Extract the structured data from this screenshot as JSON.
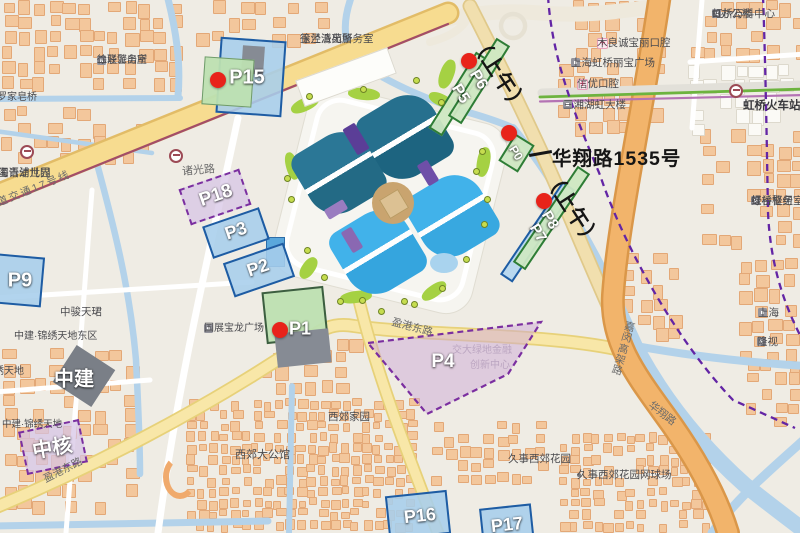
{
  "annotations": {
    "morning_top": "（上午）",
    "morning_mid": "（上午）",
    "address": "华翔路1535号"
  },
  "parking": {
    "shapes": [
      {
        "cls": "blue",
        "cx": 251,
        "cy": 77,
        "w": 66,
        "h": 76,
        "rot": 4
      },
      {
        "cls": "gray",
        "cx": 253,
        "cy": 60,
        "w": 22,
        "h": 28,
        "rot": 4
      },
      {
        "cls": "green",
        "cx": 228,
        "cy": 82,
        "w": 50,
        "h": 48,
        "rot": 4
      },
      {
        "cls": "greenbar",
        "cx": 459,
        "cy": 94,
        "w": 16,
        "h": 90,
        "rot": 32
      },
      {
        "cls": "greenbar",
        "cx": 479,
        "cy": 81,
        "w": 16,
        "h": 92,
        "rot": 32
      },
      {
        "cls": "greenbar",
        "cx": 516,
        "cy": 153,
        "w": 23,
        "h": 32,
        "rot": 32
      },
      {
        "cls": "bluebar",
        "cx": 537,
        "cy": 232,
        "w": 15,
        "h": 112,
        "rot": 34
      },
      {
        "cls": "greenbar",
        "cx": 551,
        "cy": 218,
        "w": 15,
        "h": 116,
        "rot": 34
      },
      {
        "cls": "pdash",
        "cx": 215,
        "cy": 197,
        "w": 64,
        "h": 38,
        "rot": -19
      },
      {
        "cls": "blue",
        "cx": 236,
        "cy": 233,
        "w": 60,
        "h": 34,
        "rot": -19
      },
      {
        "cls": "blue",
        "cx": 259,
        "cy": 270,
        "w": 64,
        "h": 36,
        "rot": -19
      },
      {
        "cls": "blue",
        "cx": 14,
        "cy": 280,
        "w": 58,
        "h": 50,
        "rot": 5
      },
      {
        "cls": "green2",
        "cx": 295,
        "cy": 315,
        "w": 62,
        "h": 52,
        "rot": -6
      },
      {
        "cls": "gray",
        "cx": 303,
        "cy": 348,
        "w": 54,
        "h": 34,
        "rot": -6
      },
      {
        "cls": "blue",
        "cx": 418,
        "cy": 515,
        "w": 62,
        "h": 44,
        "rot": -6
      },
      {
        "cls": "blue",
        "cx": 507,
        "cy": 526,
        "w": 52,
        "h": 40,
        "rot": -6
      },
      {
        "cls": "darkgray",
        "cx": 84,
        "cy": 376,
        "w": 46,
        "h": 44,
        "rot": 33
      },
      {
        "cls": "pdash",
        "cx": 53,
        "cy": 447,
        "w": 62,
        "h": 44,
        "rot": -12
      }
    ],
    "labels": [
      {
        "t": "P15",
        "x": 247,
        "y": 78,
        "s": 20
      },
      {
        "t": "P6",
        "x": 478,
        "y": 80,
        "s": 16,
        "r": 58
      },
      {
        "t": "P5",
        "x": 460,
        "y": 94,
        "s": 16,
        "r": 58
      },
      {
        "t": "P0",
        "x": 516,
        "y": 153,
        "s": 12,
        "r": 58
      },
      {
        "t": "P8",
        "x": 550,
        "y": 220,
        "s": 15,
        "r": 58
      },
      {
        "t": "P7",
        "x": 538,
        "y": 233,
        "s": 15,
        "r": 58
      },
      {
        "t": "P18",
        "x": 216,
        "y": 196,
        "s": 19,
        "r": -19
      },
      {
        "t": "P3",
        "x": 236,
        "y": 231,
        "s": 18,
        "r": -19
      },
      {
        "t": "P2",
        "x": 258,
        "y": 268,
        "s": 18,
        "r": -19
      },
      {
        "t": "P9",
        "x": 20,
        "y": 281,
        "s": 20
      },
      {
        "t": "P1",
        "x": 300,
        "y": 329,
        "s": 18
      },
      {
        "t": "P4",
        "x": 443,
        "y": 362,
        "s": 19
      },
      {
        "t": "P16",
        "x": 420,
        "y": 516,
        "s": 18,
        "r": -6
      },
      {
        "t": "P17",
        "x": 507,
        "y": 525,
        "s": 18,
        "r": -6
      },
      {
        "t": "中建",
        "x": 74,
        "y": 377,
        "s": 20
      },
      {
        "t": "中核",
        "x": 52,
        "y": 446,
        "s": 20,
        "r": -10
      }
    ],
    "red_dots": [
      [
        218,
        80
      ],
      [
        469,
        61
      ],
      [
        509,
        133
      ],
      [
        544,
        201
      ],
      [
        280,
        330
      ]
    ],
    "p4_polygon": "368,343 541,322 508,374 427,414"
  },
  "necc": {
    "grounds": {
      "cx": 390,
      "cy": 200,
      "w": 206,
      "h": 196,
      "rot": 14
    },
    "ring": {
      "cx": 390,
      "cy": 200,
      "w": 186,
      "h": 176,
      "rot": 14
    },
    "leaves": [
      {
        "cx": 405,
        "cy": 137,
        "s": 78,
        "rot": 59,
        "c1": "#26708e",
        "c2": "#1d6480"
      },
      {
        "cx": 339,
        "cy": 173,
        "s": 76,
        "rot": 59,
        "c1": "#2b7796",
        "c2": "#236a85"
      },
      {
        "cx": 378,
        "cy": 252,
        "s": 78,
        "rot": 59,
        "c1": "#41b2ea",
        "c2": "#35a5de"
      },
      {
        "cx": 452,
        "cy": 216,
        "s": 76,
        "rot": 59,
        "c1": "#41b2ea",
        "c2": "#38a8e0"
      }
    ],
    "purples": [
      {
        "cx": 356,
        "cy": 139,
        "w": 30,
        "h": 14,
        "rot": 59,
        "c": "#5b3e97"
      },
      {
        "cx": 428,
        "cy": 173,
        "w": 24,
        "h": 12,
        "rot": 59,
        "c": "#6f4fa8"
      },
      {
        "cx": 336,
        "cy": 209,
        "w": 22,
        "h": 11,
        "rot": -31,
        "c": "#9a7cc0"
      },
      {
        "cx": 352,
        "cy": 240,
        "w": 24,
        "h": 12,
        "rot": 59,
        "c": "#8a68b2"
      }
    ],
    "lawns": [
      {
        "cx": 305,
        "cy": 104,
        "w": 30,
        "h": 13,
        "rot": -25
      },
      {
        "cx": 364,
        "cy": 94,
        "w": 32,
        "h": 12,
        "rot": 5
      },
      {
        "cx": 441,
        "cy": 100,
        "w": 26,
        "h": 12,
        "rot": 25
      },
      {
        "cx": 483,
        "cy": 162,
        "w": 13,
        "h": 30,
        "rot": 10
      },
      {
        "cx": 486,
        "cy": 224,
        "w": 13,
        "h": 28,
        "rot": 25
      },
      {
        "cx": 434,
        "cy": 291,
        "w": 28,
        "h": 12,
        "rot": -35
      },
      {
        "cx": 356,
        "cy": 297,
        "w": 32,
        "h": 12,
        "rot": -8
      },
      {
        "cx": 292,
        "cy": 166,
        "w": 12,
        "h": 28,
        "rot": -15
      },
      {
        "cx": 447,
        "cy": 74,
        "w": 14,
        "h": 30,
        "rot": 20
      },
      {
        "cx": 308,
        "cy": 268,
        "w": 13,
        "h": 24,
        "rot": 35
      }
    ],
    "center": {
      "cx": 393,
      "cy": 203,
      "r": 21,
      "c": "#c9a46f",
      "sq": 20,
      "sqc": "#dcc193"
    },
    "pond": {
      "cx": 444,
      "cy": 263,
      "w": 28,
      "h": 20,
      "c": "#a9d3ee"
    },
    "west_building": {
      "cx": 274,
      "cy": 251,
      "w": 17,
      "h": 28,
      "c": "#5aa7dc",
      "bc": "#2d6da8"
    },
    "white_building": {
      "cx": 345,
      "cy": 76,
      "w": 96,
      "h": 26,
      "rot": -20
    },
    "arc_building": {
      "cx": 180,
      "cy": 477,
      "w": 34,
      "h": 44
    }
  },
  "streets": [
    {
      "t": "诸光路",
      "x": 182,
      "y": 163,
      "r": -5,
      "s": 11
    },
    {
      "t": "轨道交通17号线",
      "x": -14,
      "y": 200,
      "r": -22,
      "s": 10.5,
      "sp": 2
    },
    {
      "t": "盈港东路",
      "x": 392,
      "y": 314,
      "r": 15,
      "s": 10.5
    },
    {
      "t": "盈港东路",
      "x": 44,
      "y": 472,
      "r": -27,
      "s": 10.5
    },
    {
      "t": "嘉闵高架路",
      "x": 618,
      "y": 320,
      "r": 16,
      "s": 10.5,
      "v": true
    },
    {
      "t": "华翔路",
      "x": 650,
      "y": 396,
      "r": 38,
      "s": 10.5
    }
  ],
  "pois": [
    {
      "l": [
        "徐泾派出所",
        "二联警务室"
      ],
      "x": 97,
      "y": 55,
      "i": "b",
      "s": 10
    },
    {
      "l": [
        "罗家皂桥"
      ],
      "x": -3,
      "y": 92,
      "s": 10
    },
    {
      "l": [
        "徐泾派出所",
        "玉兰清苑警务室"
      ],
      "x": 300,
      "y": 33,
      "s": 10.5
    },
    {
      "l": [
        "虹桥万科中心",
        "t8办公楼"
      ],
      "x": 712,
      "y": 8,
      "i": "b",
      "s": 10.5
    },
    {
      "l": [
        "木良诚宝丽口腔"
      ],
      "x": 597,
      "y": 37,
      "i": "c",
      "s": 10.5
    },
    {
      "l": [
        "上海虹桥丽宝广场"
      ],
      "x": 571,
      "y": 57,
      "i": "b",
      "s": 10.5
    },
    {
      "l": [
        "信优口腔"
      ],
      "x": 577,
      "y": 78,
      "ia": "c",
      "s": 10.5
    },
    {
      "l": [
        "三湘湖虹大楼"
      ],
      "x": 563,
      "y": 99,
      "i": "b",
      "s": 10.5
    },
    {
      "l": [
        "虹桥火车站"
      ],
      "x": 743,
      "y": 99,
      "cls": "sta",
      "s": 11.5
    },
    {
      "l": [
        "虹桥枢纽",
        "绿谷警务室"
      ],
      "x": 751,
      "y": 195,
      "i": "b",
      "s": 10.5
    },
    {
      "l": [
        "上海"
      ],
      "x": 758,
      "y": 307,
      "i": "b",
      "s": 10.5
    },
    {
      "l": [
        "隆视"
      ],
      "x": 757,
      "y": 336,
      "i": "b",
      "s": 10.5
    },
    {
      "l": [
        "国展宝龙广场"
      ],
      "x": 204,
      "y": 323,
      "i": "b",
      "s": 10
    },
    {
      "l": [
        "中骏天珺"
      ],
      "x": 60,
      "y": 306,
      "s": 10.5
    },
    {
      "l": [
        "中建·锦绣天地东区"
      ],
      "x": 14,
      "y": 331,
      "s": 10
    },
    {
      "l": [
        "锦绣天地"
      ],
      "x": -16,
      "y": 366,
      "s": 10
    },
    {
      "l": [
        "中建·锦绣天地"
      ],
      "x": 2,
      "y": 419,
      "s": 9.5
    },
    {
      "l": [
        "西郊大公馆"
      ],
      "x": 235,
      "y": 449,
      "s": 11
    },
    {
      "l": [
        "西郊家园"
      ],
      "x": 328,
      "y": 411,
      "s": 10.5
    },
    {
      "l": [
        "久事西郊花园"
      ],
      "x": 508,
      "y": 453,
      "s": 10.5
    },
    {
      "l": [
        "久事西郊花园网球场"
      ],
      "x": 577,
      "y": 469,
      "i": "d",
      "s": 10.5
    },
    {
      "l": [
        "海青浦世界",
        "国语幼儿园"
      ],
      "x": -2,
      "y": 167,
      "s": 10.5
    },
    {
      "l": [
        "交大绿地金融"
      ],
      "x": 452,
      "y": 345,
      "cls": "faint",
      "layer": "u",
      "s": 10
    },
    {
      "l": [
        "创新中心"
      ],
      "x": 470,
      "y": 360,
      "cls": "faint",
      "layer": "u",
      "s": 10
    }
  ],
  "transit": {
    "stations": [
      [
        27,
        152
      ],
      [
        176,
        156
      ],
      [
        736,
        91
      ]
    ],
    "bus_stops": [
      [
        309,
        96
      ],
      [
        363,
        89
      ],
      [
        416,
        80
      ],
      [
        441,
        102
      ],
      [
        476,
        171
      ],
      [
        482,
        151
      ],
      [
        487,
        199
      ],
      [
        484,
        224
      ],
      [
        466,
        259
      ],
      [
        442,
        288
      ],
      [
        404,
        301
      ],
      [
        362,
        300
      ],
      [
        324,
        277
      ],
      [
        307,
        250
      ],
      [
        291,
        199
      ],
      [
        287,
        178
      ],
      [
        340,
        301
      ],
      [
        381,
        311
      ],
      [
        414,
        304
      ]
    ]
  },
  "map_geo": {
    "paths": [
      {
        "d": "M345,58 C420,18 480,8 540,13 C590,17 625,10 660,6",
        "w": 15,
        "c": "#eee9dc"
      },
      {
        "d": "M430,42 C460,34 468,22 471,8",
        "w": 8,
        "c": "#eee9dc"
      },
      {
        "d": "M513,14 a12,12 0 1,0 0.1,0",
        "w": 4.5,
        "c": "#e6e1d3"
      },
      {
        "d": "M167,-5 C176,30 181,62 178,96",
        "w": 7,
        "c": "#b3d2ea"
      },
      {
        "d": "M-5,99 L180,98",
        "w": 6,
        "c": "#b3d2ea"
      },
      {
        "d": "M-5,131 L152,153",
        "w": 4.5,
        "c": "#b3d2ea"
      },
      {
        "d": "M96,160 C115,230 130,290 136,360 C139,420 140,455 140,474",
        "w": 6.5,
        "c": "#b3d2ea"
      },
      {
        "d": "M-5,526 L268,521",
        "w": 7,
        "c": "#b3d2ea"
      },
      {
        "d": "M292,386 L289,533",
        "w": 6,
        "c": "#b3d2ea"
      },
      {
        "d": "M352,-5 C341,25 343,47 362,64 C390,84 430,100 460,110 C485,117 500,122 513,128",
        "w": 7,
        "c": "#b3d2ea"
      },
      {
        "d": "M513,128 C545,168 585,230 618,300 C632,330 640,348 648,365",
        "w": 8,
        "c": "#b3d2ea"
      },
      {
        "d": "M640,355 C665,400 700,445 745,485 C770,505 790,520 806,532",
        "w": 16,
        "c": "#b3d2ea"
      },
      {
        "d": "M615,342 C680,355 740,362 806,366",
        "w": 8,
        "c": "#b3d2ea"
      },
      {
        "d": "M806,438 C770,470 735,500 712,533",
        "w": 9,
        "c": "#b3d2ea"
      },
      {
        "d": "M238,118 C210,250 178,380 158,533",
        "w": 7,
        "c": "#ffffff"
      },
      {
        "d": "M-5,298 L252,282",
        "w": 5,
        "c": "#ffffff"
      },
      {
        "d": "M-5,392 L150,380",
        "w": 5,
        "c": "#ffffff"
      },
      {
        "d": "M92,190 L66,533",
        "w": 5,
        "c": "#ffffff"
      },
      {
        "d": "M690,62 L806,54",
        "w": 5,
        "c": "#ffffff"
      },
      {
        "d": "M702,0 L692,128",
        "w": 5,
        "c": "#ffffff"
      },
      {
        "d": "M-6,196 L448,13",
        "w": 23,
        "c": "#e2bc67"
      },
      {
        "d": "M-6,196 L448,13",
        "w": 18,
        "c": "#f7dc90"
      },
      {
        "d": "M-6,508 C90,468 200,412 300,345 C322,329 332,322 354,326 C420,336 540,333 616,349",
        "w": 14,
        "c": "#e7d179"
      },
      {
        "d": "M-6,508 C90,468 200,412 300,345 C322,329 332,322 354,326 C420,336 540,333 616,349",
        "w": 10.5,
        "c": "#f8e7a8"
      },
      {
        "d": "M358,296 C375,370 408,455 438,533",
        "w": 13,
        "c": "#e7d179"
      },
      {
        "d": "M358,296 C375,370 408,455 438,533",
        "w": 9.5,
        "c": "#f8e7a8"
      },
      {
        "d": "M470,6 C495,55 520,105 545,160 C570,215 600,290 622,336",
        "w": 15,
        "c": "#e0c98a"
      },
      {
        "d": "M470,6 C495,55 520,105 545,160 C570,215 600,290 622,336",
        "w": 11.5,
        "c": "#f1dfae"
      },
      {
        "d": "M660,-6 C645,100 618,220 613,295 C610,345 640,380 672,425 C700,465 718,500 728,533",
        "w": 24,
        "c": "#da9749"
      },
      {
        "d": "M660,-6 C645,100 618,220 613,295 C610,345 640,380 672,425 C700,465 718,500 728,533",
        "w": 19,
        "c": "#f2b46b"
      },
      {
        "d": "M542,93 L806,85",
        "w": 9,
        "c": "#e2e0d9"
      },
      {
        "d": "M540,97 L806,89",
        "w": 2.8,
        "c": "#6db33f"
      },
      {
        "d": "M540,101.5 L806,95",
        "w": 2.2,
        "c": "#b473b4"
      },
      {
        "d": "M-6,207 L448,24",
        "w": 2.2,
        "c": "#a34d68"
      }
    ],
    "boundaries": [
      {
        "d": "M548,-4 C552,60 575,115 600,175 C625,250 680,345 733,400 L795,428"
      },
      {
        "d": "M763,-4 C766,80 767,160 768,212 C770,260 782,300 800,335"
      }
    ],
    "boundary_color": "#6325a5"
  },
  "building_clusters": [
    {
      "x": 2,
      "y": 0,
      "w": 175,
      "h": 92,
      "seed": 1,
      "c": "o",
      "p": 0.72,
      "cell": 15,
      "s0": 8,
      "s1": 13
    },
    {
      "x": 195,
      "y": 0,
      "w": 125,
      "h": 38,
      "seed": 2,
      "c": "o",
      "p": 0.6,
      "cell": 15,
      "s0": 8,
      "s1": 13
    },
    {
      "x": 0,
      "y": 106,
      "w": 150,
      "h": 52,
      "seed": 3,
      "c": "o",
      "p": 0.55,
      "cell": 15,
      "s0": 8,
      "s1": 13
    },
    {
      "x": 558,
      "y": 0,
      "w": 95,
      "h": 132,
      "seed": 4,
      "c": "o",
      "p": 0.7,
      "cell": 15,
      "s0": 8,
      "s1": 13
    },
    {
      "x": 688,
      "y": 0,
      "w": 112,
      "h": 58,
      "seed": 5,
      "c": "o",
      "p": 0.7,
      "cell": 15,
      "s0": 8,
      "s1": 13
    },
    {
      "x": 700,
      "y": 128,
      "w": 100,
      "h": 118,
      "seed": 6,
      "c": "o",
      "p": 0.55,
      "cell": 15,
      "s0": 8,
      "s1": 13
    },
    {
      "x": 622,
      "y": 252,
      "w": 58,
      "h": 88,
      "seed": 7,
      "c": "o",
      "p": 0.5,
      "cell": 15,
      "s0": 8,
      "s1": 13
    },
    {
      "x": 737,
      "y": 258,
      "w": 63,
      "h": 98,
      "seed": 8,
      "c": "o",
      "p": 0.6,
      "cell": 15,
      "s0": 8,
      "s1": 13
    },
    {
      "x": 185,
      "y": 398,
      "w": 230,
      "h": 132,
      "seed": 9,
      "c": "o",
      "p": 0.85,
      "cell": 11,
      "s0": 5,
      "s1": 9
    },
    {
      "x": 2,
      "y": 348,
      "w": 128,
      "h": 165,
      "seed": 10,
      "c": "o",
      "p": 0.5,
      "cell": 15,
      "s0": 8,
      "s1": 13
    },
    {
      "x": 558,
      "y": 432,
      "w": 155,
      "h": 98,
      "seed": 11,
      "c": "o",
      "p": 0.8,
      "cell": 11,
      "s0": 5,
      "s1": 9
    },
    {
      "x": 258,
      "y": 335,
      "w": 108,
      "h": 62,
      "seed": 12,
      "c": "o",
      "p": 0.5,
      "cell": 15,
      "s0": 8,
      "s1": 13
    },
    {
      "x": 430,
      "y": 420,
      "w": 118,
      "h": 68,
      "seed": 13,
      "c": "o",
      "p": 0.6,
      "cell": 13,
      "s0": 6,
      "s1": 10
    },
    {
      "x": 688,
      "y": 62,
      "w": 108,
      "h": 66,
      "seed": 14,
      "c": "w",
      "p": 0.65,
      "cell": 15,
      "s0": 9,
      "s1": 14
    },
    {
      "x": 745,
      "y": 358,
      "w": 55,
      "h": 72,
      "seed": 15,
      "c": "o",
      "p": 0.6,
      "cell": 14,
      "s0": 7,
      "s1": 11
    }
  ]
}
